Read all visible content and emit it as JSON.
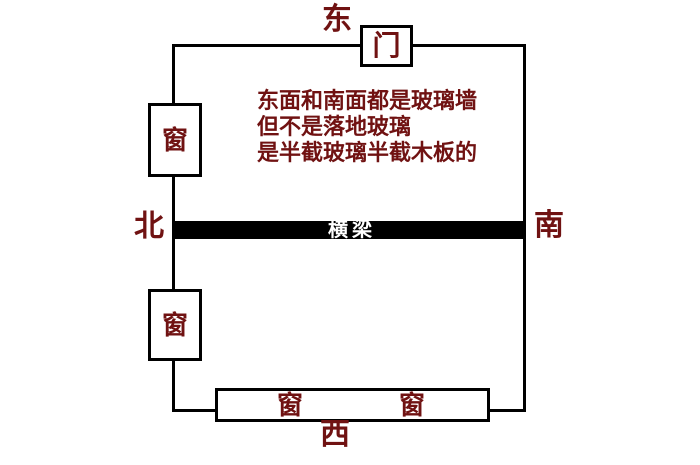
{
  "diagram": {
    "compass": {
      "east": "东",
      "north": "北",
      "south": "南",
      "west": "西"
    },
    "door": {
      "label": "门"
    },
    "windows": {
      "left_top_label": "窗",
      "left_bottom_label": "窗",
      "bottom_left_label": "窗",
      "bottom_right_label": "窗"
    },
    "beam": {
      "label": "横梁"
    },
    "note": {
      "line1": "东面和南面都是玻璃墙",
      "line2": "但不是落地玻璃",
      "line3": "是半截玻璃半截木板的"
    },
    "colors": {
      "accent_text": "#701212",
      "wall": "#000000",
      "beam_fill": "#000000",
      "beam_text": "#ffffff",
      "background": "#ffffff"
    }
  }
}
